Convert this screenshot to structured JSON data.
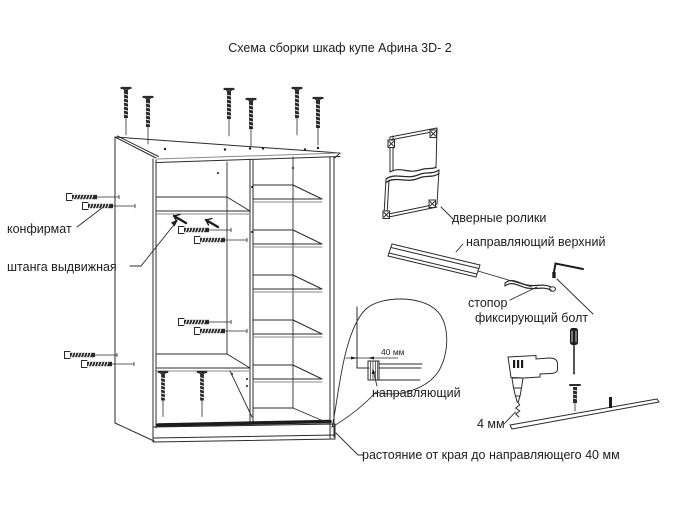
{
  "title": "Схема сборки шкаф купе Афина  3D- 2",
  "labels": {
    "konfirmat": "конфирмат",
    "shtanga_vydvizhnaya": "штанга выдвижная",
    "dvernye_roliki": "дверные ролики",
    "napravlyayushchiy_verkhniy": "направляющий верхний",
    "stopor": "стопор",
    "fiksiruyushchiy_bolt": "фиксирующий болт",
    "napravlyayushchiy": "направляющий",
    "drill_bit_size": "4 мм",
    "detail_dimension": "40 мм",
    "edge_distance_note": "растояние от края до направляющего  40 мм"
  },
  "colors": {
    "line": "#2b2b2b",
    "dark_fill": "#1c1c1c",
    "background": "#ffffff"
  }
}
